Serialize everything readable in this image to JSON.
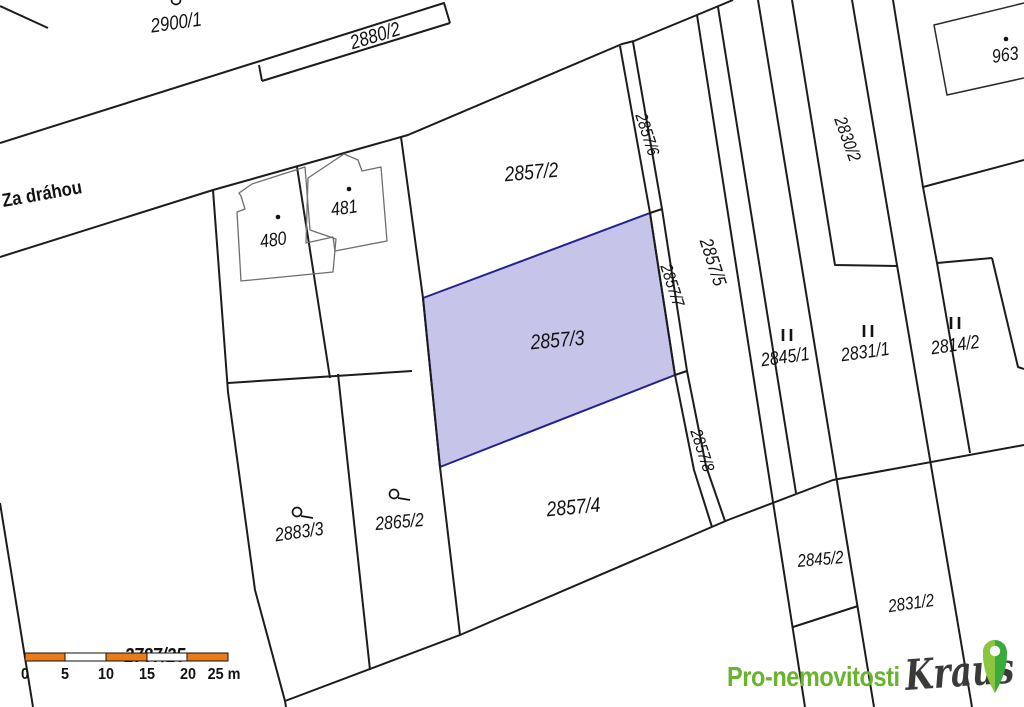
{
  "street": {
    "label": "Za dráhou"
  },
  "parcels": {
    "p2900_1": "2900/1",
    "p2880_2": "2880/2",
    "p2857_2": "2857/2",
    "p2857_3": "2857/3",
    "p2857_4": "2857/4",
    "p2857_5": "2857/5",
    "p2857_6": "2857/6",
    "p2857_7": "2857/7",
    "p2857_8": "2857/8",
    "p2830_2": "2830/2",
    "p2845_1": "2845/1",
    "p2831_1": "2831/1",
    "p2814_2": "2814/2",
    "p2845_2": "2845/2",
    "p2831_2": "2831/2",
    "p2883_3": "2883/3",
    "p2865_2": "2865/2",
    "p2787_25": "2787/25",
    "b480": "480",
    "b481": "481",
    "b963": "963"
  },
  "highlight": {
    "parcel": "2857/3",
    "fill": "#c7c4e9",
    "stroke": "#23238f"
  },
  "scalebar": {
    "ticks": [
      "0",
      "5",
      "10",
      "15",
      "20",
      "25 m"
    ],
    "bar_color": "#e87b1a"
  },
  "logo": {
    "brand": "Pro-nemovitosti",
    "name": "Kraus",
    "brand_color": "#6ab42d",
    "name_color": "#3a3a39",
    "pin_left": "#8cc63e",
    "pin_right": "#3aab3a"
  }
}
